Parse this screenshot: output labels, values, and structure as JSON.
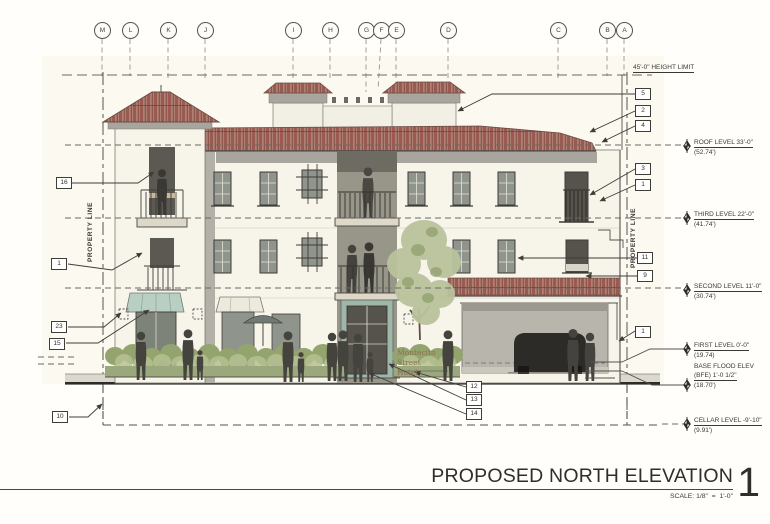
{
  "drawing": {
    "title": "PROPOSED NORTH ELEVATION",
    "sheet_number": "1",
    "scale_label": "SCALE: 1/8\"  =  1'-0\"",
    "height_limit_label": "45'-0\" HEIGHT LIMIT",
    "property_line_label_left": "PROPERTY LINE",
    "property_line_label_right": "PROPERTY LINE",
    "building_sign_line1": "Montecito Street",
    "building_sign_line2": "Hotel"
  },
  "grid_markers": [
    "M",
    "L",
    "K",
    "J",
    "I",
    "H",
    "G",
    "F",
    "E",
    "D",
    "C",
    "B",
    "A"
  ],
  "levels": [
    {
      "name": "ROOF LEVEL 33'-0\"",
      "elevation": "(52.74')"
    },
    {
      "name": "THIRD LEVEL 22'-0\"",
      "elevation": "(41.74')"
    },
    {
      "name": "SECOND LEVEL 11'-0\"",
      "elevation": "(30.74')"
    },
    {
      "name": "FIRST LEVEL 0'-0\"",
      "elevation": "(19.74)"
    },
    {
      "name": "BASE FLOOD ELEV",
      "name2": "(BFE) 1'-0 1/2\"",
      "elevation": "(18.70')"
    },
    {
      "name": "CELLAR LEVEL -9'-10\"",
      "elevation": "(9.91')"
    }
  ],
  "callouts": {
    "left": [
      "16",
      "1",
      "23",
      "15",
      "10"
    ],
    "right": [
      "5",
      "2",
      "4",
      "3",
      "1",
      "11",
      "9",
      "1"
    ],
    "bottom": [
      "12",
      "13",
      "14"
    ]
  },
  "colors": {
    "roof_tile": "#9a5a50",
    "wall": "#f7f4ea",
    "fascia_gray": "#a7a59d",
    "awning_teal": "#b9cfc3",
    "foliage": "#b9c39b",
    "line": "#3f3d38"
  }
}
